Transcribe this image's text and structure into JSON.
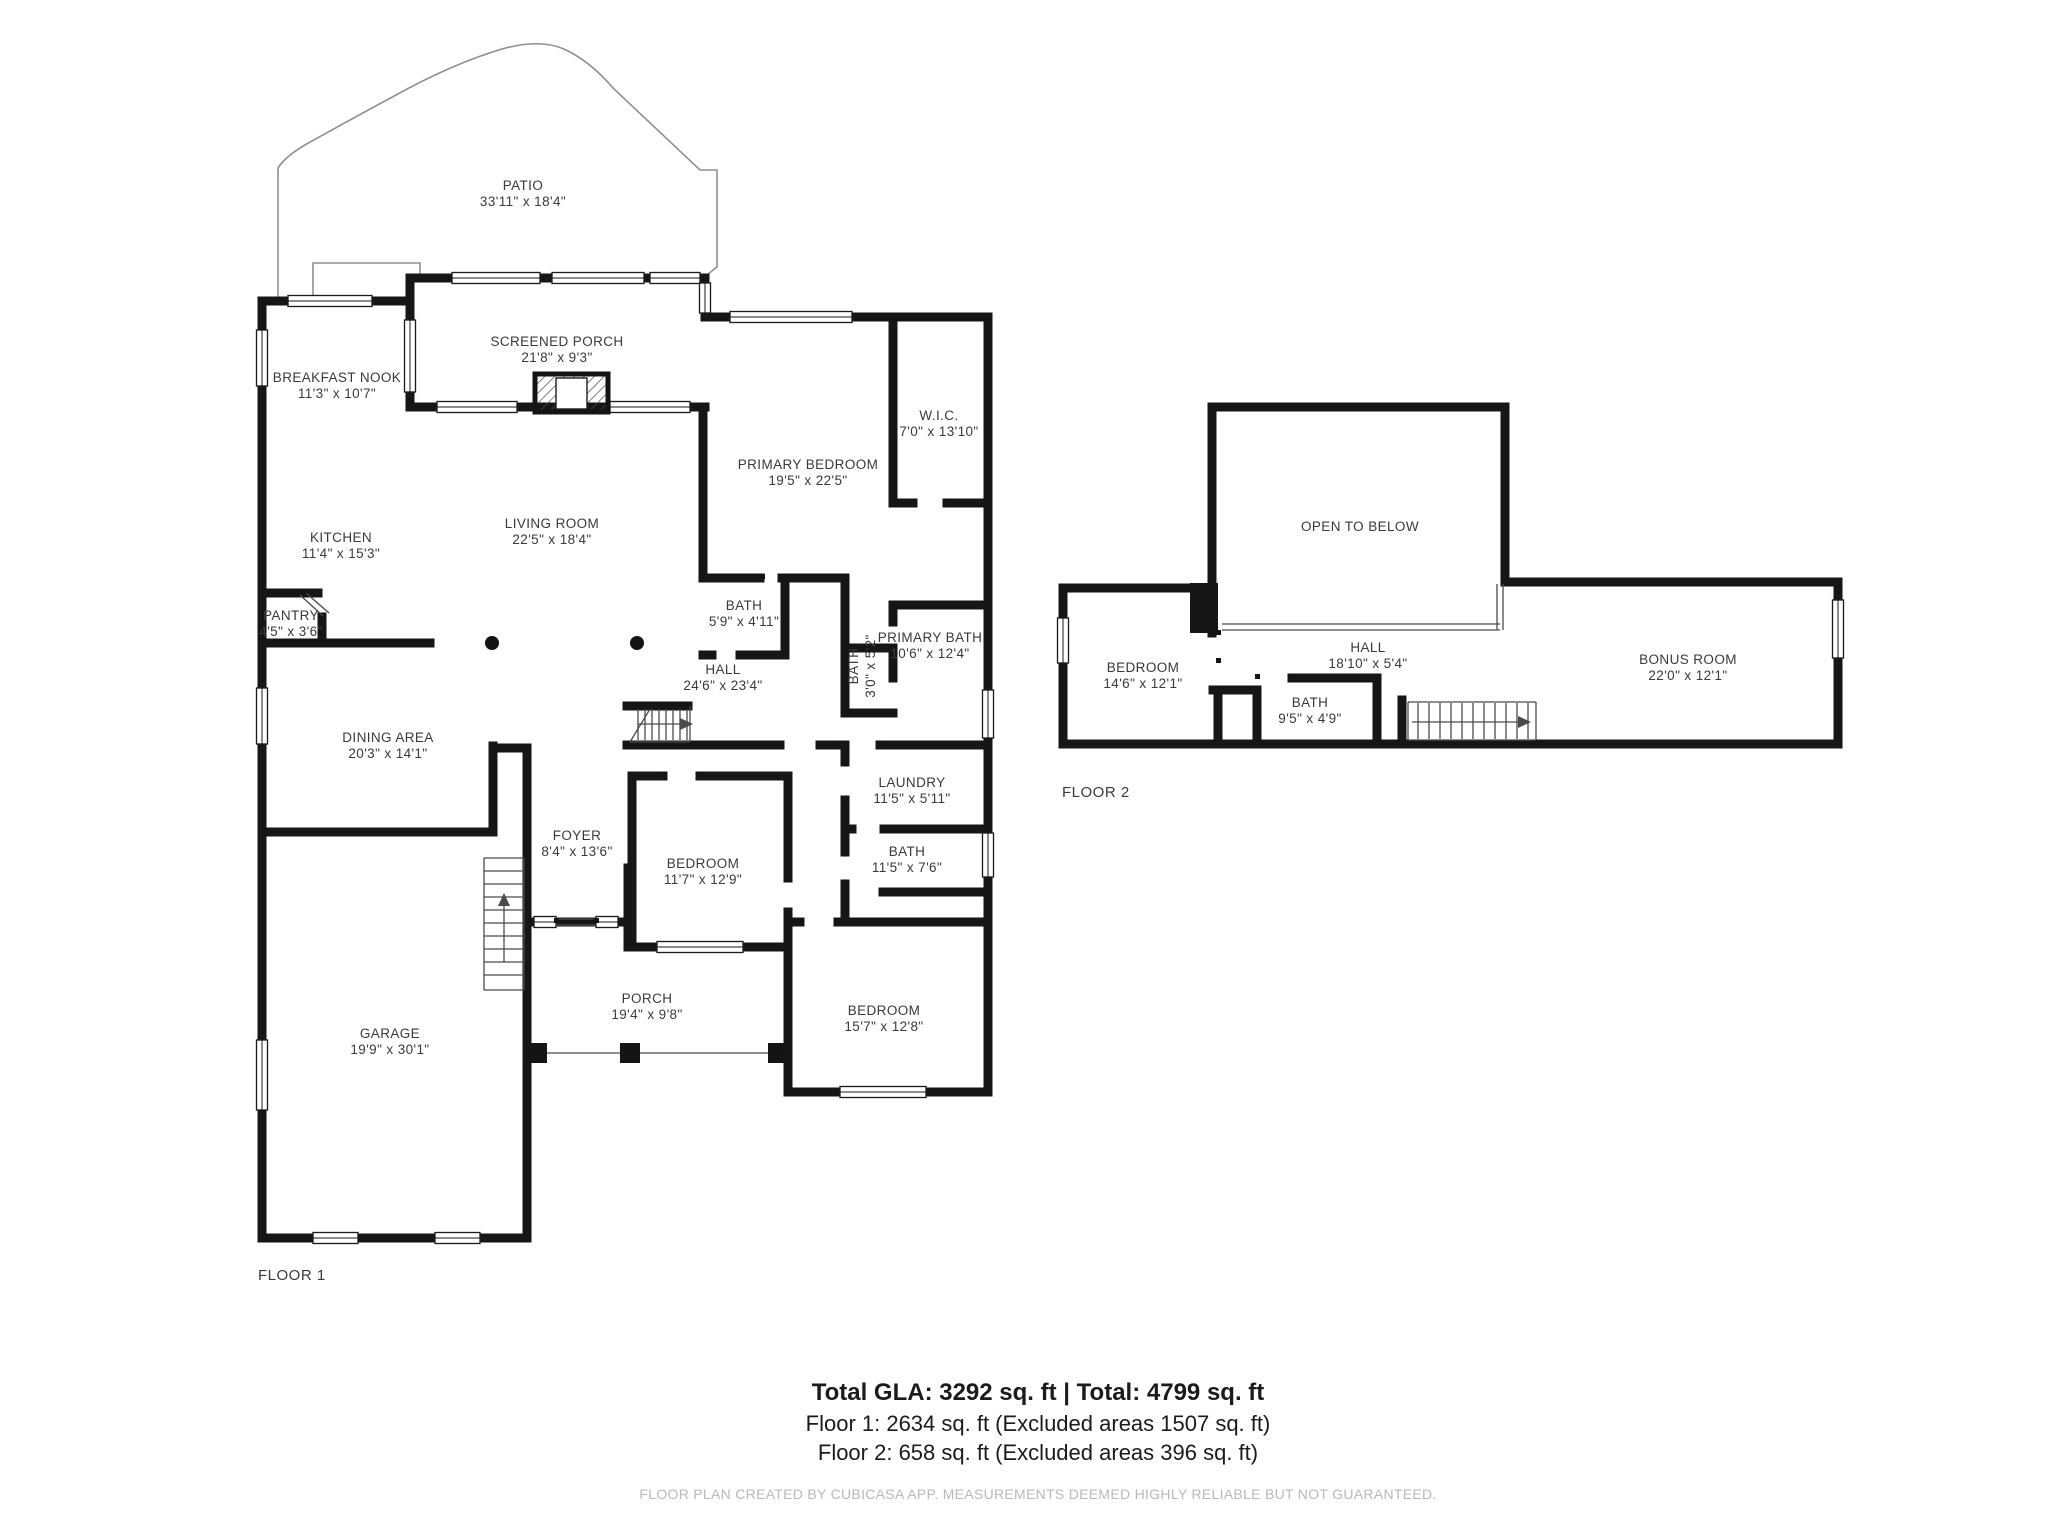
{
  "floor1": {
    "label": "FLOOR 1",
    "rooms": {
      "patio": {
        "name": "PATIO",
        "dims": "33'11\" x 18'4\""
      },
      "screened_porch": {
        "name": "SCREENED PORCH",
        "dims": "21'8\" x 9'3\""
      },
      "breakfast_nook": {
        "name": "BREAKFAST NOOK",
        "dims": "11'3\" x 10'7\""
      },
      "kitchen": {
        "name": "KITCHEN",
        "dims": "11'4\" x 15'3\""
      },
      "living_room": {
        "name": "LIVING ROOM",
        "dims": "22'5\" x 18'4\""
      },
      "pantry": {
        "name": "PANTRY",
        "dims": "4'5\" x 3'6\""
      },
      "primary_bedroom": {
        "name": "PRIMARY BEDROOM",
        "dims": "19'5\" x 22'5\""
      },
      "wic": {
        "name": "W.I.C.",
        "dims": "7'0\" x 13'10\""
      },
      "bath": {
        "name": "BATH",
        "dims": "5'9\" x 4'11\""
      },
      "hall": {
        "name": "HALL",
        "dims": "24'6\" x 23'4\""
      },
      "primary_bath": {
        "name": "PRIMARY BATH",
        "dims": "10'6\" x 12'4\""
      },
      "small_bath": {
        "name": "BATH",
        "dims": "3'0\" x 5'2\""
      },
      "dining_area": {
        "name": "DINING AREA",
        "dims": "20'3\" x 14'1\""
      },
      "laundry": {
        "name": "LAUNDRY",
        "dims": "11'5\" x 5'11\""
      },
      "foyer": {
        "name": "FOYER",
        "dims": "8'4\" x 13'6\""
      },
      "bedroom2": {
        "name": "BEDROOM",
        "dims": "11'7\" x 12'9\""
      },
      "bath2": {
        "name": "BATH",
        "dims": "11'5\" x 7'6\""
      },
      "garage": {
        "name": "GARAGE",
        "dims": "19'9\" x 30'1\""
      },
      "porch": {
        "name": "PORCH",
        "dims": "19'4\" x 9'8\""
      },
      "bedroom3": {
        "name": "BEDROOM",
        "dims": "15'7\" x 12'8\""
      }
    }
  },
  "floor2": {
    "label": "FLOOR 2",
    "rooms": {
      "open_to_below": {
        "name": "OPEN TO BELOW",
        "dims": ""
      },
      "bedroom": {
        "name": "BEDROOM",
        "dims": "14'6\" x 12'1\""
      },
      "hall": {
        "name": "HALL",
        "dims": "18'10\" x 5'4\""
      },
      "bath": {
        "name": "BATH",
        "dims": "9'5\" x 4'9\""
      },
      "bonus_room": {
        "name": "BONUS ROOM",
        "dims": "22'0\" x 12'1\""
      }
    }
  },
  "summary": {
    "total": "Total GLA: 3292 sq. ft | Total: 4799 sq. ft",
    "floor1": "Floor 1: 2634 sq. ft (Excluded areas 1507 sq. ft)",
    "floor2": "Floor 2: 658 sq. ft (Excluded areas 396 sq. ft)"
  },
  "footer": {
    "note": "FLOOR PLAN CREATED BY CUBICASA APP. MEASUREMENTS DEEMED HIGHLY RELIABLE BUT NOT GUARANTEED."
  },
  "colors": {
    "wall": "#161616",
    "label_text": "#3a3a3a",
    "summary_text": "#1b1b1b",
    "footer_text": "#b9b9b9"
  }
}
